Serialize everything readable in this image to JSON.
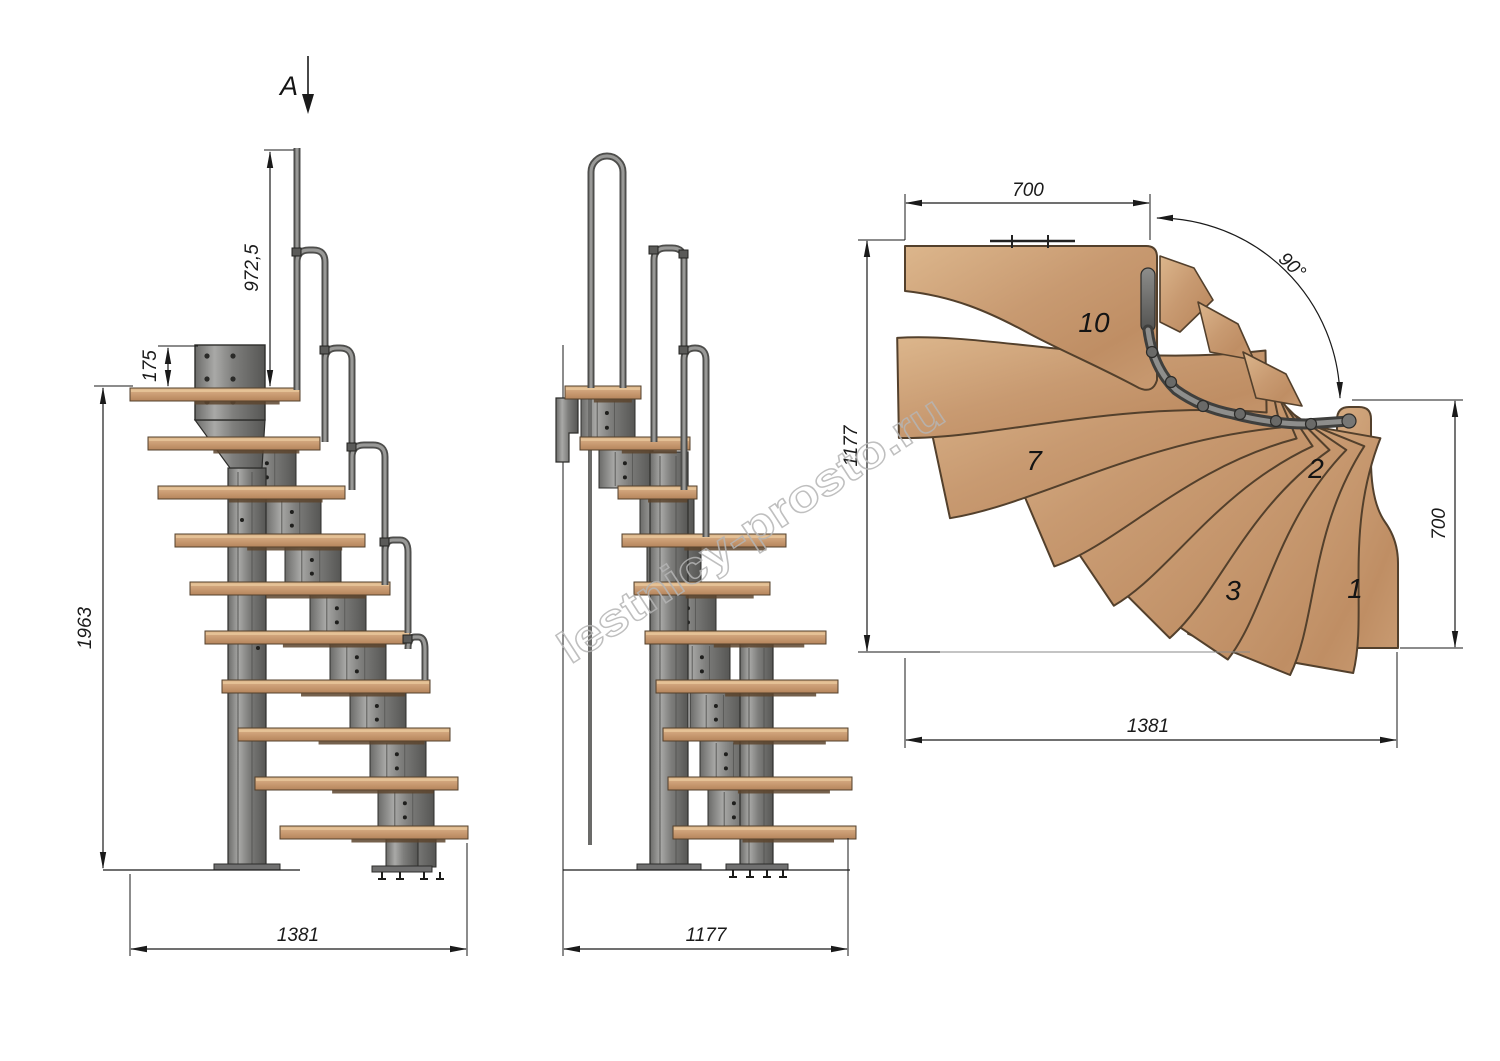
{
  "colors": {
    "background": "#ffffff",
    "line": "#1a1a1a",
    "wood": "#c89a71",
    "wood_light": "#dcb68c",
    "wood_dark": "#8a5c3a",
    "wood_outline": "#53402c",
    "metal": "#7e7e7c",
    "metal_light": "#a9a9a7",
    "metal_dark": "#4e4e4c",
    "metal_outline": "#2d2d2b",
    "watermark": "#b5b5b5"
  },
  "watermark": {
    "text": "lestnicy-prosto.ru"
  },
  "section_mark": {
    "label": "A"
  },
  "side_view": {
    "dimensions": {
      "handrail_height": "972,5",
      "bracket_offset": "175",
      "total_height": "1963",
      "total_run": "1381"
    }
  },
  "front_view": {
    "dimensions": {
      "total_width": "1177"
    }
  },
  "plan_view": {
    "dimensions": {
      "upper_flight_width": "700",
      "plan_depth": "1177",
      "lower_flight_width": "700",
      "plan_length": "1381",
      "turn_angle": "90°"
    },
    "step_numbers": [
      {
        "label": "10"
      },
      {
        "label": "7"
      },
      {
        "label": "2"
      },
      {
        "label": "3"
      },
      {
        "label": "1"
      }
    ]
  }
}
